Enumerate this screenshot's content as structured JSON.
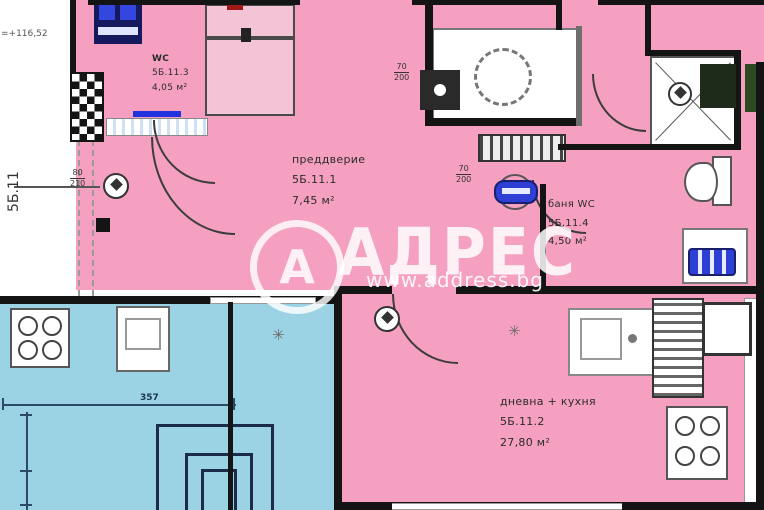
{
  "watermark": {
    "logo_letter": "А",
    "brand": "АДРЕС",
    "url": "www.address.bg"
  },
  "plan": {
    "elevation_label": "=+116,52",
    "unit_label": "5Б.11",
    "rooms": {
      "wc": {
        "name": "WC",
        "number": "5Б.11.3",
        "area": "4,05 м²"
      },
      "vestibule": {
        "name": "преддверие",
        "number": "5Б.11.1",
        "area": "7,45 м²"
      },
      "bath": {
        "name": "баня WC",
        "number": "5Б.11.4",
        "area": "4,50 м²"
      },
      "living": {
        "name": "дневна + кухня",
        "number": "5Б.11.2",
        "area": "27,80 м²"
      }
    },
    "door_labels": {
      "entrance": {
        "width": "80",
        "height": "210"
      },
      "wc": {
        "width": "70",
        "height": "200"
      },
      "bath": {
        "width": "70",
        "height": "200"
      }
    },
    "dimensions": {
      "kitchen_width": "357"
    },
    "symbols": {
      "vent": "✳"
    }
  },
  "colors": {
    "unit_fill": "#f5a0c0",
    "neighbor_fill": "#9bd2e4",
    "wall": "#141414",
    "accent_blue": "#2d3fd4"
  }
}
